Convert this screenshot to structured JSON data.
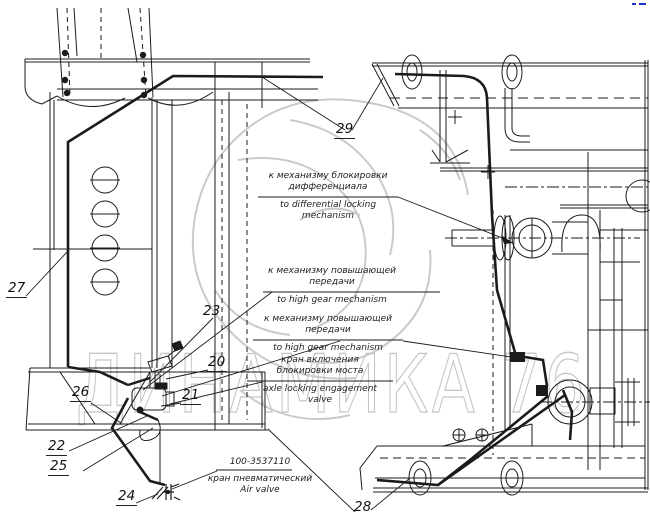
{
  "diagram": {
    "watermark_text": "ДИНАМИКА 76",
    "callouts": {
      "c20": "20",
      "c21": "21",
      "c22": "22",
      "c23": "23",
      "c24": "24",
      "c25": "25",
      "c26": "26",
      "c27": "27",
      "c28": "28",
      "c29": "29"
    },
    "labels": {
      "diff_lock": {
        "ru1": "к механизму блокировки",
        "ru2": "дифференциала",
        "en1": "to differential locking",
        "en2": "mechanism"
      },
      "high_gear_1": {
        "ru1": "к механизму повышающей",
        "ru2": "передачи",
        "en": "to high gear mechanism"
      },
      "high_gear_2": {
        "ru1": "к механизму повышающей",
        "ru2": "передачи",
        "en": "to high gear mechanism"
      },
      "axle_lock": {
        "ru1": "кран включения",
        "ru2": "блокировки моста",
        "en1": "axle locking engagement",
        "en2": "valve"
      },
      "air_valve": {
        "part_number": "100-3537110",
        "ru": "кран пневматический",
        "en": "Air valve"
      }
    },
    "colors": {
      "line": "#1b1b1b",
      "watermark": "#c5c5c5",
      "accent_blue": "#2233cc"
    }
  }
}
